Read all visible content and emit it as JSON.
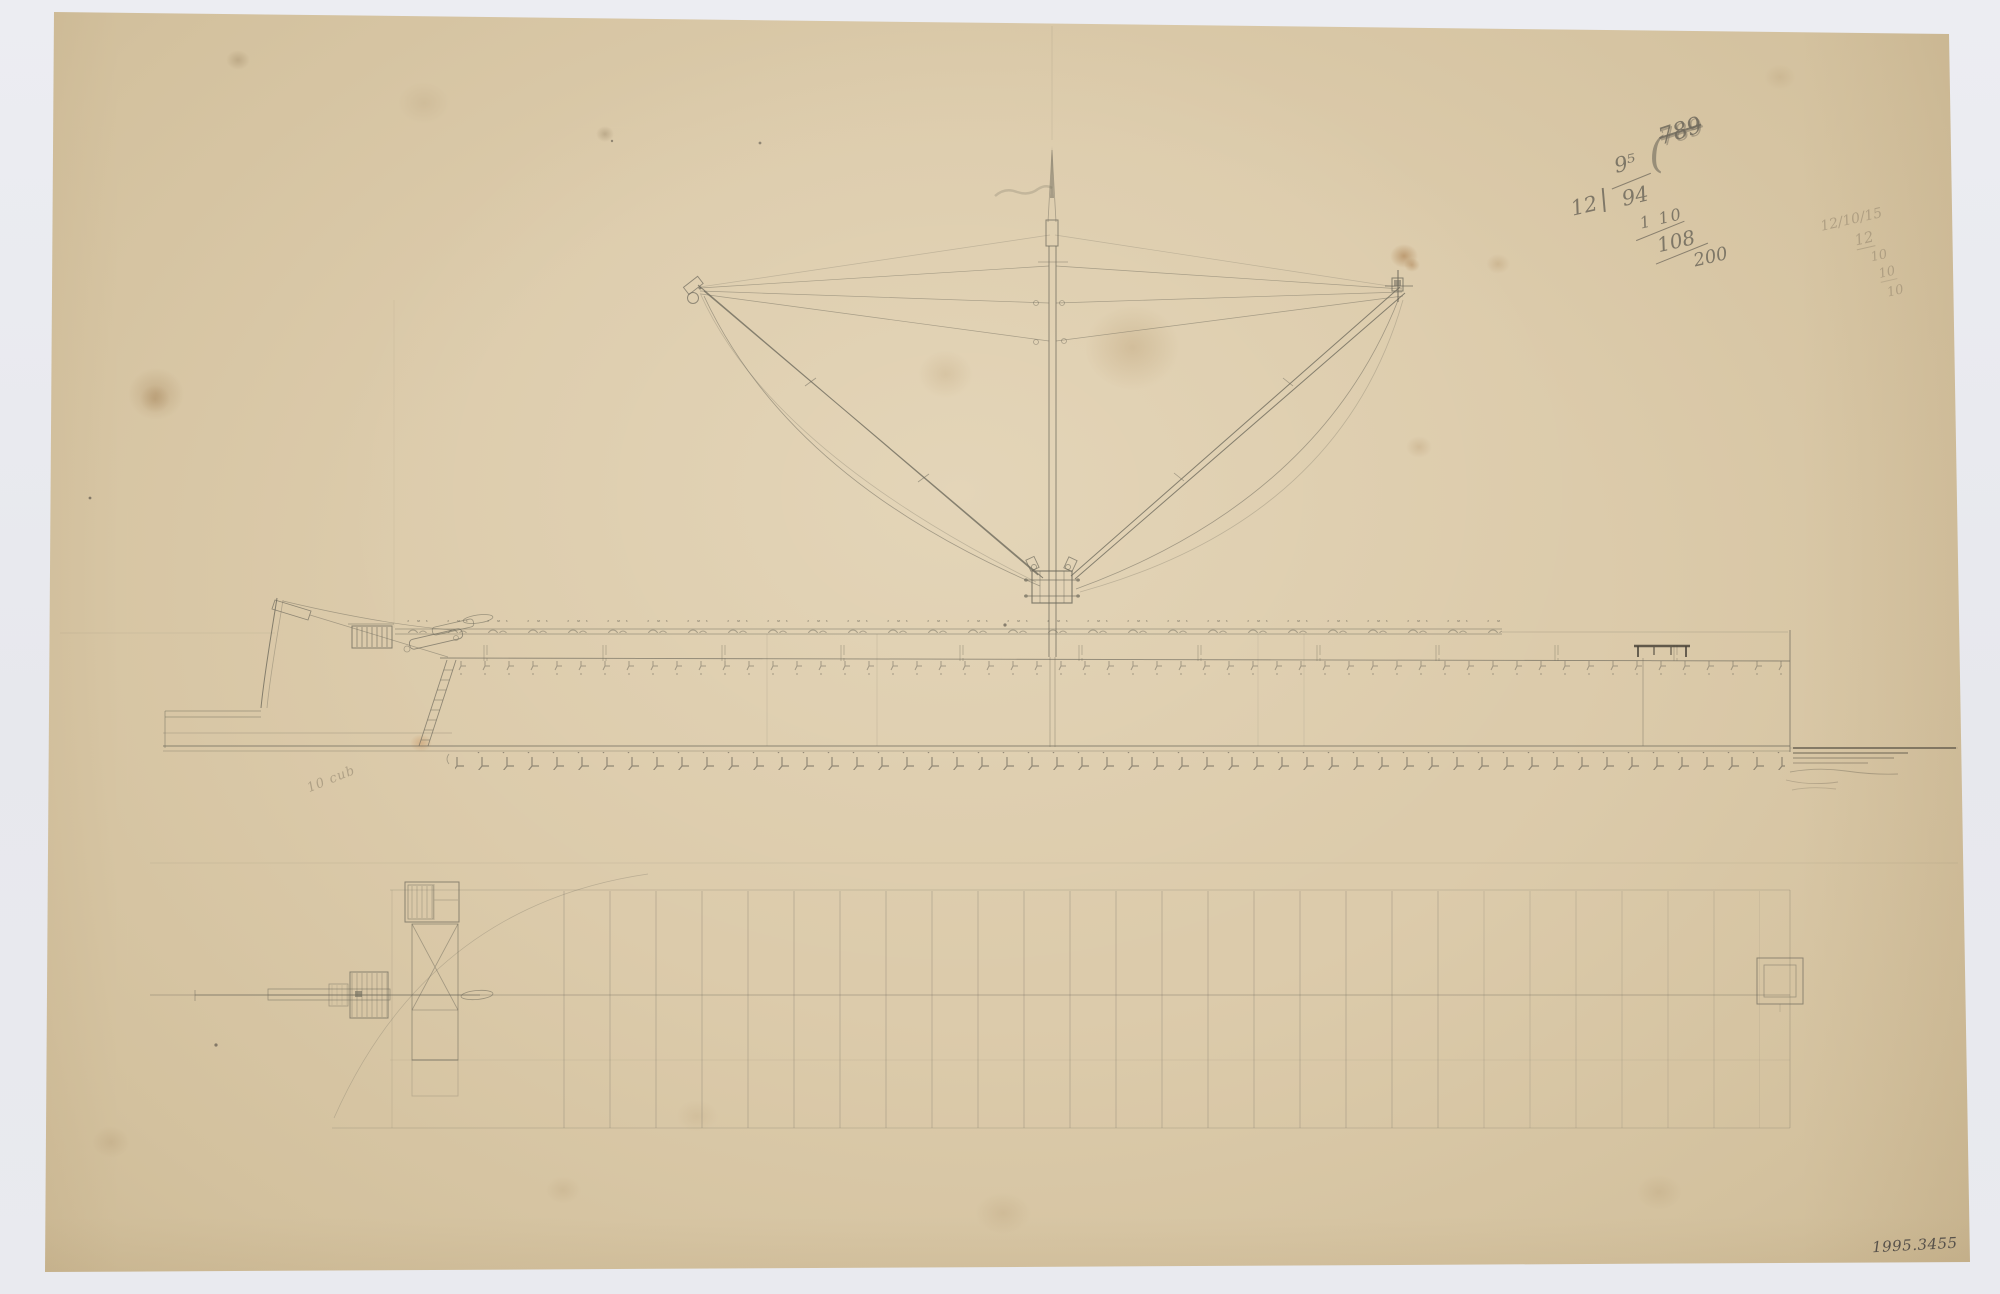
{
  "page": {
    "backdrop_color": "#e9eaef",
    "paper_color": "#d8c7a6",
    "pencil_color": "#6e6a5c",
    "faint_pencil_color": "#a4977e"
  },
  "annotations": {
    "calc_top_right": {
      "prefix": "12",
      "divider": "|",
      "numerator": "9⁵",
      "denominator": "94",
      "paren": "(",
      "struck": "789",
      "row2": "1 10",
      "row3": "108",
      "row4": "200"
    },
    "date_note": {
      "line1": "12/10/15",
      "line2": "12",
      "line3": "10",
      "line4": "10",
      "line5": "10"
    },
    "hull_note": "10 cub",
    "inventory_number": "1995.3455"
  }
}
